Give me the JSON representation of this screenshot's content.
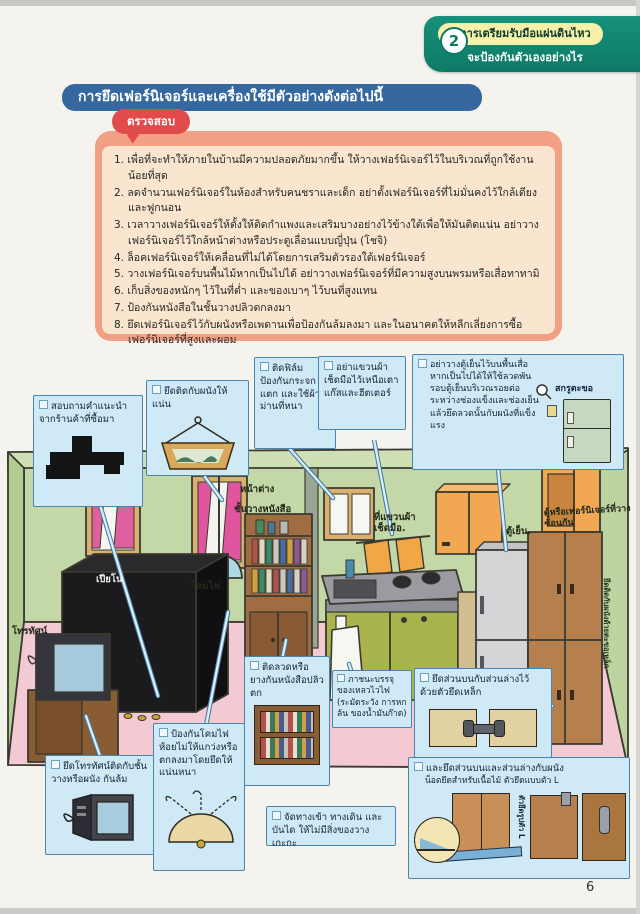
{
  "header": {
    "badge_number": "2",
    "tab_title": "การเตรียมรับมือแผ่นดินไหว",
    "tab_subtitle": "จะป้องกันตัวเองอย่างไร"
  },
  "section": {
    "title": "การยึดเฟอร์นิเจอร์และเครื่องใช้มีตัวอย่างดังต่อไปนี้",
    "check_bubble": "ตรวจสอบ"
  },
  "checklist": [
    "1. เพื่อที่จะทำให้ภายในบ้านมีความปลอดภัยมากขึ้น ให้วางเฟอร์นิเจอร์ไว้ในบริเวณที่ถูกใช้งานน้อยที่สุด",
    "2. ลดจำนวนเฟอร์นิเจอร์ในห้องสำหรับคนชราและเด็ก อย่าตั้งเฟอร์นิเจอร์ที่ไม่มั่นคงไว้ใกล้เตียงและฟูกนอน",
    "3. เวลาวางเฟอร์นิเจอร์ให้ตั้งให้ติดกำแพงและเสริมบางอย่างไว้ข้างใต้เพื่อให้มันติดแน่น อย่าวางเฟอร์นิเจอร์ไว้ใกล้หน้าต่างหรือประตูเลื่อนแบบญี่ปุ่น (โชจิ)",
    "4. ล็อคเฟอร์นิเจอร์ให้เคลื่อนที่ไม่ได้โดยการเสริมตัวรองใต้เฟอร์นิเจอร์",
    "5. วางเฟอร์นิเจอร์บนพื้นไม้หากเป็นไปได้ อย่าวางเฟอร์นิเจอร์ที่มีความสูงบนพรมหรือเสื่อทาทามิ",
    "6. เก็บสิ่งของหนักๆ ไว้ในที่ต่ำ และของเบาๆ ไว้บนที่สูงแทน",
    "7. ป้องกันหนังสือในชั้นวางปลิวตกลงมา",
    "8. ยึดเฟอร์นิเจอร์ไว้กับผนังหรือเพดานเพื่อป้องกันล้มลงมา และในอนาคตให้หลีกเลี่ยงการซื้อเฟอร์นิเจอร์ที่สูงและผอม"
  ],
  "callouts": {
    "advice": "สอบถามคำแนะนำจากร้านค้าที่ซื้อมา",
    "frame": "ยึดติดกับผนังให้แน่น",
    "film": "ติดฟิล์มป้องกันกระจกแตก และใช้ผ้าม่านที่หนา",
    "towel": "อย่าแขวนผ้าเช็ดมือไว้เหนือเตาแก๊สและฮีตเตอร์",
    "fridge": "อย่าวางตู้เย็นไว้บนพื้นเสื่อ หากเป็นไปได้ให้ใช้ลวดพันรอบตู้เย็นบริเวณรอยต่อระหว่างช่องแข็งและช่องเย็นแล้วยึดลวดนั้นกับผนังที่แข็งแรง",
    "fridge_hook": "สกรูตะขอ",
    "tv": "ยึดโทรทัศน์ติดกับชั้นวางหรือผนัง กันล้ม",
    "lamp": "ป้องกันโคมไฟห้อยไม่ให้แกว่งหรือตกลงมาโดยยึดให้แน่นหนา",
    "books": "ติดลวดหรือยางกันหนังสือปลิวตก",
    "flammable": "ภาชนะบรรจุของเหลวไวไฟ (ระมัดระวัง การหกล้น ของน้ำมันก๊าด)",
    "bracket": "ยึดส่วนบนกับส่วนล่างไว้ด้วยตัวยึดเหล็ก",
    "clear_path": "จัดทางเข้า ทางเดิน และบันได ให้ไม่มีสิ่งของวางเกะกะ",
    "wall_anchor_line1": "และยึดส่วนบนและส่วนล่างกับผนัง",
    "wall_anchor_line2": "น็อตยึดสำหรับเนื้อไม้ ตัวยึดแบบตัว L",
    "l_bracket": "ตัวยึดรูปตัว L"
  },
  "room_labels": {
    "piano": "เปียโน",
    "tv": "โทรทัศน์",
    "lamp": "โคมไฟ",
    "window": "หน้าต่าง",
    "bookshelf": "ชั้นวางหนังสือ",
    "towel_rail": "ที่แขวนผ้าเช็ดมือ.",
    "fridge": "ตู้เย็น.",
    "stacked": "ตู้หรือเฟอร์นิเจอร์ที่วางซ้อนกัน",
    "wall_fix": "ยึดติดกับผนังด้วยตะขอเหล็ก"
  },
  "page_number": "6",
  "colors": {
    "tab_green": "#0e7a66",
    "banner_blue": "#35689f",
    "bubble_red": "#e24b4b",
    "box_salmon": "#f2a083",
    "box_peach": "#fae6cf",
    "callout_blue": "#cfeaf6",
    "callout_border": "#4a85ad",
    "wall_green": "#c3d8a6",
    "floor_pink": "#f3c9d3"
  }
}
